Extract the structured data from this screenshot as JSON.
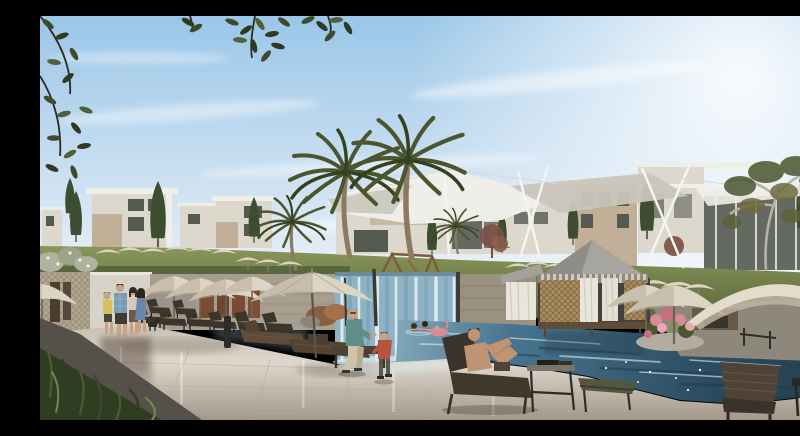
{
  "scene": {
    "type": "architectural_rendering",
    "subject": "resort_pool_courtyard",
    "description": "Photorealistic architectural rendering of a resort pool courtyard: modern white villas, tensile shade sails and palm trees on a lawn hill behind a waterfall wall that spills into a blue swimming pool with swimmers and a pink flamingo float; curtained cabanas, cream umbrellas, dark sun loungers, a standing family with a dog, a seated man, a walking child and a man reclining on a lounger occupy the polished stone deck, with overhanging leaves at the top corners and dark grass in the lower left.",
    "objects": [
      "sky",
      "clouds",
      "sun-glow",
      "villas",
      "glass-pavilion",
      "shade-sails",
      "masts",
      "palm-trees",
      "cypress-trees",
      "autumn-tree",
      "red-trees",
      "lawn",
      "playground",
      "terrace-umbrellas",
      "white-shrub",
      "changing-rooms-wall",
      "stone-wall",
      "waterfall-wall",
      "copper-shrub",
      "swimming-pool",
      "swimmers",
      "flamingo-float",
      "cabana",
      "curtained-cabana",
      "flower-planter",
      "stone-terrace",
      "pool-deck",
      "deck-reflections",
      "standing-family",
      "dog",
      "covered-daybed",
      "umbrella-cluster",
      "center-umbrella",
      "sun-loungers",
      "sitting-man",
      "walking-child",
      "reclining-man",
      "side-table",
      "foot-lounger",
      "right-bench",
      "right-table",
      "right-umbrellas",
      "bollard",
      "planter-edge",
      "foreground-grass",
      "overhanging-leaves"
    ]
  },
  "palette": {
    "sky-top": "#9ac6e8",
    "sky-mid": "#cfe2f2",
    "sky-low": "#eef4f9",
    "glow": "#ffffff",
    "building-white": "#efeee7",
    "building-shade": "#dcd8cd",
    "building-beige": "#c1b097",
    "window-dark": "#555a50",
    "glass-dark": "#646a62",
    "lawn-light": "#8a9659",
    "lawn-dark": "#5a683c",
    "cypress": "#3d4d2f",
    "palm-frond": "#4b5530",
    "palm-frond-dark": "#35401f",
    "palm-trunk": "#8b7a62",
    "sail-bright": "#efeee9",
    "sail-shade": "#c9c5ba",
    "mast": "#f4f4f0",
    "wall-stone": "#a89e8e",
    "wall-white": "#d7d3c9",
    "wall-lattice": "#b2a694",
    "door-wood": "#7a4a33",
    "door-dark": "#4a3d30",
    "waterfall-base": "#8fb2c4",
    "waterfall-light": "#d9e9ef",
    "waterfall-dark": "#7da6bb",
    "pool-light": "#9fc0ce",
    "pool-mid": "#47748f",
    "pool-dark": "#2c4b5e",
    "ripple-light": "#cfe4ec",
    "ripple-dark": "#1f3d50",
    "deck-light": "#ded7cc",
    "deck-mid": "#c9c0b3",
    "deck-dark": "#a2978a",
    "umbrella-cream": "#ddd5c3",
    "umbrella-shade": "#b7ad99",
    "lounger-dark": "#3c352a",
    "wood-warm": "#5f4c38",
    "cabana-roof": "#a7a5a0",
    "cabana-wood": "#a98f62",
    "curtain": "#e9e5da",
    "interior-dark": "#45413a",
    "flower-pink": "#d98b93",
    "foliage-dark": "#39452a",
    "grass-fg": "#2f3d22",
    "skin": "#c9a183",
    "skin-tan": "#c09472",
    "shirt-teal": "#5f8f86",
    "shirt-blue": "#7a9ab5",
    "shirt-yellow": "#d9c05e",
    "shirt-red": "#b5543e",
    "dress-blue": "#6a87a8",
    "pants-khaki": "#cfc4a6",
    "stone-terrace": "#8e877c",
    "planter-dark": "#55504a"
  }
}
